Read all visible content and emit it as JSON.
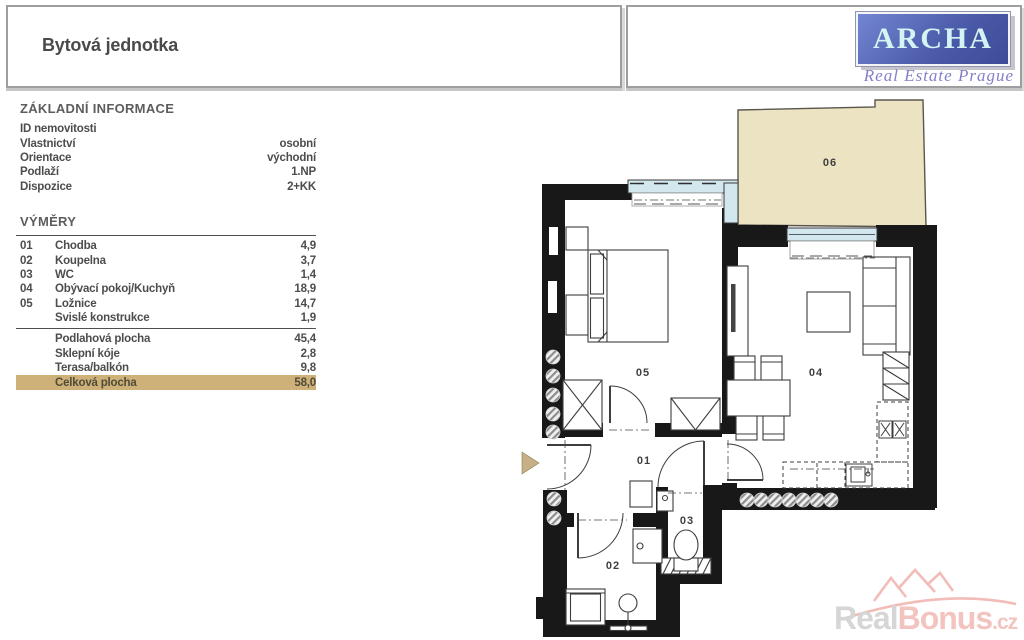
{
  "header": {
    "title": "Bytová jednotka",
    "logo_text": "ARCHA",
    "logo_subtitle": "Real Estate Prague"
  },
  "basic_info": {
    "title": "ZÁKLADNÍ INFORMACE",
    "rows": [
      {
        "label": "ID nemovitosti",
        "value": ""
      },
      {
        "label": "Vlastnictví",
        "value": "osobní"
      },
      {
        "label": "Orientace",
        "value": "východní"
      },
      {
        "label": "Podlaží",
        "value": "1.NP"
      },
      {
        "label": "Dispozice",
        "value": "2+KK"
      }
    ]
  },
  "dimensions": {
    "title": "VÝMĚRY",
    "rooms": [
      {
        "num": "01",
        "label": "Chodba",
        "value": "4,9"
      },
      {
        "num": "02",
        "label": "Koupelna",
        "value": "3,7"
      },
      {
        "num": "03",
        "label": "WC",
        "value": "1,4"
      },
      {
        "num": "04",
        "label": "Obývací pokoj/Kuchyň",
        "value": "18,9"
      },
      {
        "num": "05",
        "label": "Ložnice",
        "value": "14,7"
      },
      {
        "num": "",
        "label": "Svislé konstrukce",
        "value": "1,9"
      }
    ],
    "totals": [
      {
        "num": "",
        "label": "Podlahová plocha",
        "value": "45,4"
      },
      {
        "num": "",
        "label": "Sklepní kóje",
        "value": "2,8"
      },
      {
        "num": "",
        "label": "Terasa/balkón",
        "value": "9,8"
      },
      {
        "num": "",
        "label": "Celková plocha",
        "value": "58,0",
        "highlight": true
      }
    ]
  },
  "floorplan": {
    "labels": [
      {
        "id": "01",
        "text": "01"
      },
      {
        "id": "02",
        "text": "02"
      },
      {
        "id": "03",
        "text": "03"
      },
      {
        "id": "04",
        "text": "04"
      },
      {
        "id": "05",
        "text": "05"
      },
      {
        "id": "06",
        "text": "06"
      }
    ],
    "watermark": {
      "part1": "Real",
      "part2": "Bonus",
      "tld": ".cz"
    }
  },
  "colors": {
    "wall": "#181818",
    "terrace_fill": "#ece3c2",
    "window_fill": "#d3e7ee",
    "highlight_row": "#cdb178",
    "logo_blue": "#4a59a8",
    "logo_letters": "#d3f4f2",
    "logo_script": "#8280c8",
    "entrance_arrow": "#c8b086",
    "watermark_gray": "#d6d6d6",
    "watermark_pink": "#f2c3bf"
  }
}
